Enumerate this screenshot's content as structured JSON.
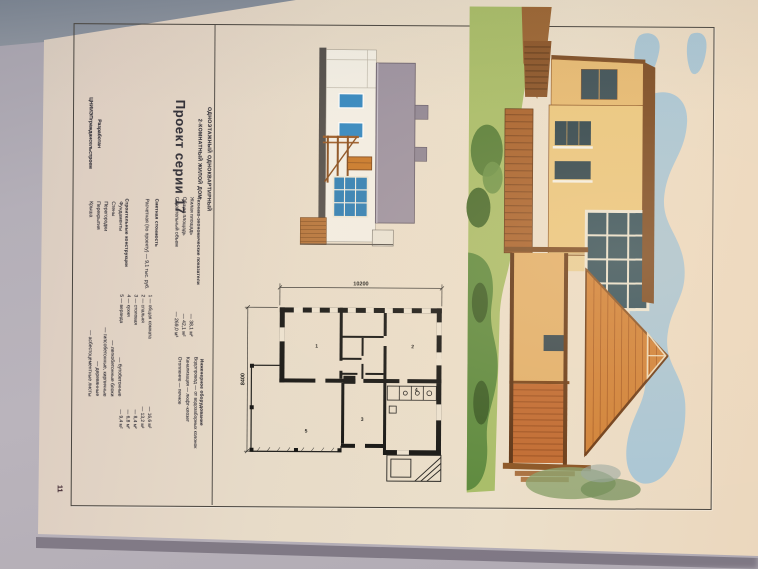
{
  "masthead": {
    "category_line1": "ОДНОЭТАЖНЫЙ ОДНОКВАРТИРНЫЙ",
    "category_line2": "2-КОМНАТНЫЙ ЖИЛОЙ ДОМ",
    "title": "Проект серии 17",
    "credit_line1": "Разработан",
    "credit_line2": "ЦНИИЭПграждансельстроем",
    "page_number": "11"
  },
  "indicators": {
    "heading": "Технико-экономические показатели",
    "rows": [
      {
        "label": "Жилая площадь",
        "value": "— 38,1 м²"
      },
      {
        "label": "Общая площадь",
        "value": "— 42,1 м²"
      },
      {
        "label": "Строительный объем",
        "value": "— 269,0 м³"
      }
    ]
  },
  "cost": {
    "heading": "Сметная стоимость",
    "row": "Расчетная (по проекту) — 9,1 тыс. руб."
  },
  "constructions": {
    "heading": "Строительные конструкции",
    "rows": [
      {
        "label": "Фундаменты",
        "value": "— бутобетонные"
      },
      {
        "label": "Стены",
        "value": "— легкобетонные блоки"
      },
      {
        "label": "Перегородки",
        "value": "— гипсобетонные, кирпичные"
      },
      {
        "label": "Перекрытия",
        "value": "— деревянные"
      },
      {
        "label": "Крыша",
        "value": "— асбестоцементные листы"
      }
    ]
  },
  "engineering": {
    "heading": "Инженерное оборудование",
    "rows": [
      "Водопровод — от водозаборных колонок",
      "Канализация — люфт-клозет",
      "Отопление — печное"
    ]
  },
  "rooms_legend": {
    "rows": [
      {
        "label": "1 — общая комната",
        "value": "— 16,6 м²"
      },
      {
        "label": "2 — спальня",
        "value": "— 13,2 м²"
      },
      {
        "label": "3 — столовая",
        "value": "— 8,4 м²"
      },
      {
        "label": "4 — кухня",
        "value": "— 6,8 м²"
      },
      {
        "label": "5 — веранда",
        "value": "— 9,4 м²"
      }
    ]
  },
  "floor_plan": {
    "dim_width": "10200",
    "dim_height": "8400",
    "rooms": [
      "1",
      "2",
      "3",
      "4",
      "5"
    ]
  },
  "palette": {
    "photo_background": "#b3aeb6",
    "page_paper": "#e8dcc9",
    "frame_line": "#49453f",
    "ink": "#35333a",
    "elevation_roof": "#9c92a0",
    "window_blue": "#3488c0",
    "wood_brown": "#a8622c",
    "roof_tile_orange": "#d08136",
    "sky_blue": "#a9c6d5",
    "lawn_green": "#a8bd68",
    "glass_dark": "#33515c"
  }
}
